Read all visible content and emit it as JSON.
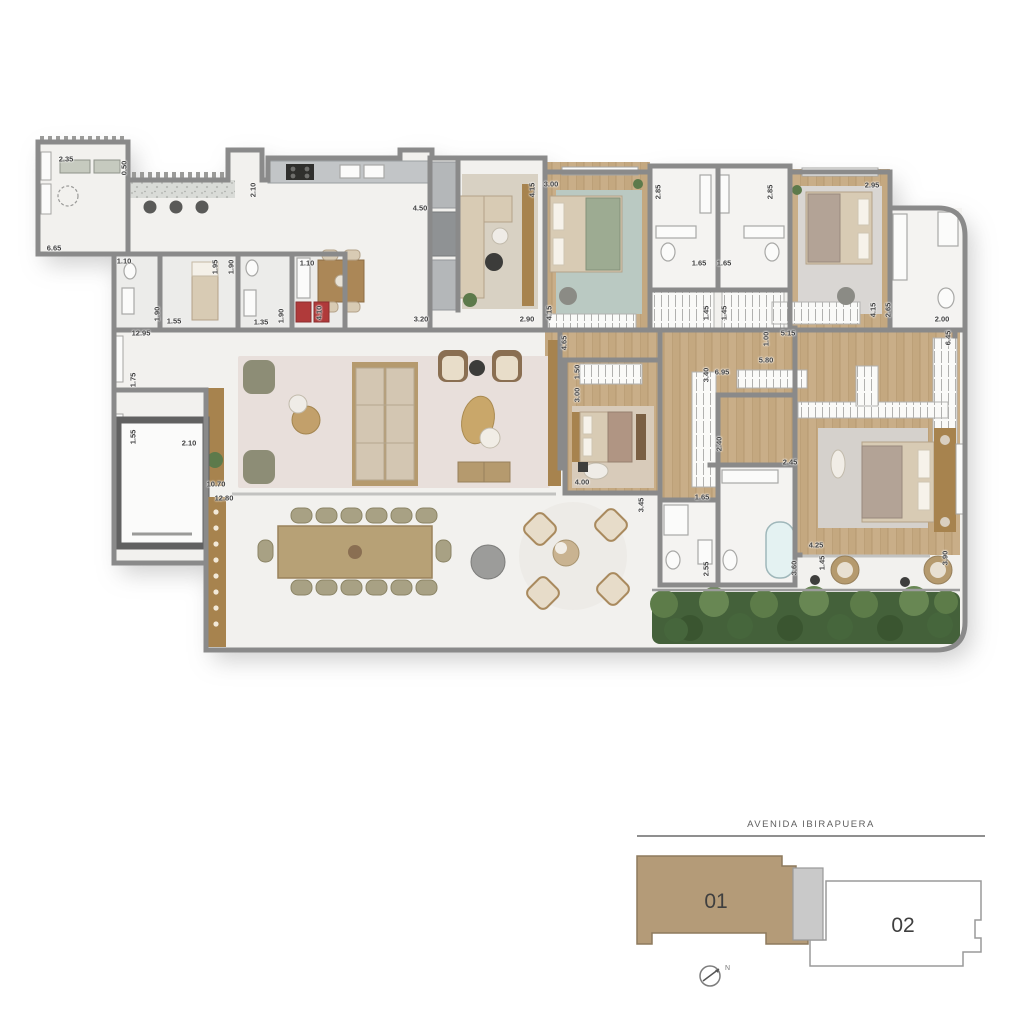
{
  "plan": {
    "type": "apartment_floor_plan",
    "dimension_labels": [
      {
        "t": "2.35",
        "x": 66,
        "y": 159,
        "r": 0
      },
      {
        "t": "0.50",
        "x": 124,
        "y": 168,
        "r": 90
      },
      {
        "t": "6.65",
        "x": 54,
        "y": 248,
        "r": 0
      },
      {
        "t": "2.10",
        "x": 253,
        "y": 190,
        "r": 90
      },
      {
        "t": "4.50",
        "x": 420,
        "y": 208,
        "r": 0
      },
      {
        "t": "1.10",
        "x": 124,
        "y": 261,
        "r": 0
      },
      {
        "t": "1.90",
        "x": 157,
        "y": 314,
        "r": 90
      },
      {
        "t": "1.95",
        "x": 215,
        "y": 267,
        "r": 90
      },
      {
        "t": "1.55",
        "x": 174,
        "y": 321,
        "r": 0
      },
      {
        "t": "1.90",
        "x": 231,
        "y": 267,
        "r": 90
      },
      {
        "t": "1.35",
        "x": 261,
        "y": 322,
        "r": 0
      },
      {
        "t": "1.90",
        "x": 281,
        "y": 316,
        "r": 90
      },
      {
        "t": "1.10",
        "x": 307,
        "y": 263,
        "r": 0
      },
      {
        "t": "4.10",
        "x": 319,
        "y": 313,
        "r": 90
      },
      {
        "t": "12.95",
        "x": 141,
        "y": 333,
        "r": 0
      },
      {
        "t": "3.20",
        "x": 421,
        "y": 319,
        "r": 0
      },
      {
        "t": "2.90",
        "x": 527,
        "y": 319,
        "r": 0
      },
      {
        "t": "4.15",
        "x": 532,
        "y": 190,
        "r": 90
      },
      {
        "t": "3.00",
        "x": 551,
        "y": 184,
        "r": 0
      },
      {
        "t": "4.15",
        "x": 549,
        "y": 313,
        "r": 90
      },
      {
        "t": "4.65",
        "x": 564,
        "y": 343,
        "r": 90
      },
      {
        "t": "2.85",
        "x": 658,
        "y": 192,
        "r": 90
      },
      {
        "t": "1.65",
        "x": 699,
        "y": 263,
        "r": 0
      },
      {
        "t": "1.45",
        "x": 706,
        "y": 313,
        "r": 90
      },
      {
        "t": "1.65",
        "x": 724,
        "y": 263,
        "r": 0
      },
      {
        "t": "1.45",
        "x": 724,
        "y": 313,
        "r": 90
      },
      {
        "t": "2.85",
        "x": 770,
        "y": 192,
        "r": 90
      },
      {
        "t": "2.95",
        "x": 872,
        "y": 185,
        "r": 0
      },
      {
        "t": "4.15",
        "x": 873,
        "y": 310,
        "r": 90
      },
      {
        "t": "2.65",
        "x": 888,
        "y": 310,
        "r": 90
      },
      {
        "t": "2.00",
        "x": 942,
        "y": 319,
        "r": 0
      },
      {
        "t": "6.45",
        "x": 948,
        "y": 338,
        "r": 90
      },
      {
        "t": "1.00",
        "x": 766,
        "y": 339,
        "r": 90
      },
      {
        "t": "5.15",
        "x": 788,
        "y": 333,
        "r": 0
      },
      {
        "t": "5.80",
        "x": 766,
        "y": 360,
        "r": 0
      },
      {
        "t": "6.95",
        "x": 722,
        "y": 372,
        "r": 0
      },
      {
        "t": "3.40",
        "x": 706,
        "y": 375,
        "r": 90
      },
      {
        "t": "1.50",
        "x": 577,
        "y": 372,
        "r": 90
      },
      {
        "t": "3.00",
        "x": 577,
        "y": 395,
        "r": 90
      },
      {
        "t": "4.00",
        "x": 582,
        "y": 482,
        "r": 0
      },
      {
        "t": "3.45",
        "x": 641,
        "y": 505,
        "r": 90
      },
      {
        "t": "1.65",
        "x": 702,
        "y": 497,
        "r": 0
      },
      {
        "t": "2.55",
        "x": 706,
        "y": 569,
        "r": 90
      },
      {
        "t": "2.40",
        "x": 719,
        "y": 444,
        "r": 90
      },
      {
        "t": "2.45",
        "x": 790,
        "y": 462,
        "r": 0
      },
      {
        "t": "3.60",
        "x": 794,
        "y": 568,
        "r": 90
      },
      {
        "t": "4.25",
        "x": 816,
        "y": 545,
        "r": 0
      },
      {
        "t": "1.45",
        "x": 822,
        "y": 563,
        "r": 90
      },
      {
        "t": "3.90",
        "x": 945,
        "y": 558,
        "r": 90
      },
      {
        "t": "1.75",
        "x": 133,
        "y": 380,
        "r": 90
      },
      {
        "t": "1.55",
        "x": 133,
        "y": 437,
        "r": 90
      },
      {
        "t": "2.10",
        "x": 189,
        "y": 443,
        "r": 0
      },
      {
        "t": "10.70",
        "x": 216,
        "y": 484,
        "r": 0
      },
      {
        "t": "12.80",
        "x": 224,
        "y": 498,
        "r": 0
      }
    ]
  },
  "key_plan": {
    "street_label": "AVENIDA IBIRAPUERA",
    "unit_01_label": "01",
    "unit_02_label": "02",
    "north_label": "N",
    "unit_01_color": "#b49b78",
    "core_color": "#c9c9c9"
  },
  "colors": {
    "wall_gray": "#8a8a8a",
    "wood_floor": "#c9ae88",
    "marble_floor": "#f2f1ee",
    "living_rug": "#e8dfdb",
    "hedge_green": "#44613a",
    "accent_wood": "#a7834e",
    "water_blue": "#e4f2f2"
  }
}
